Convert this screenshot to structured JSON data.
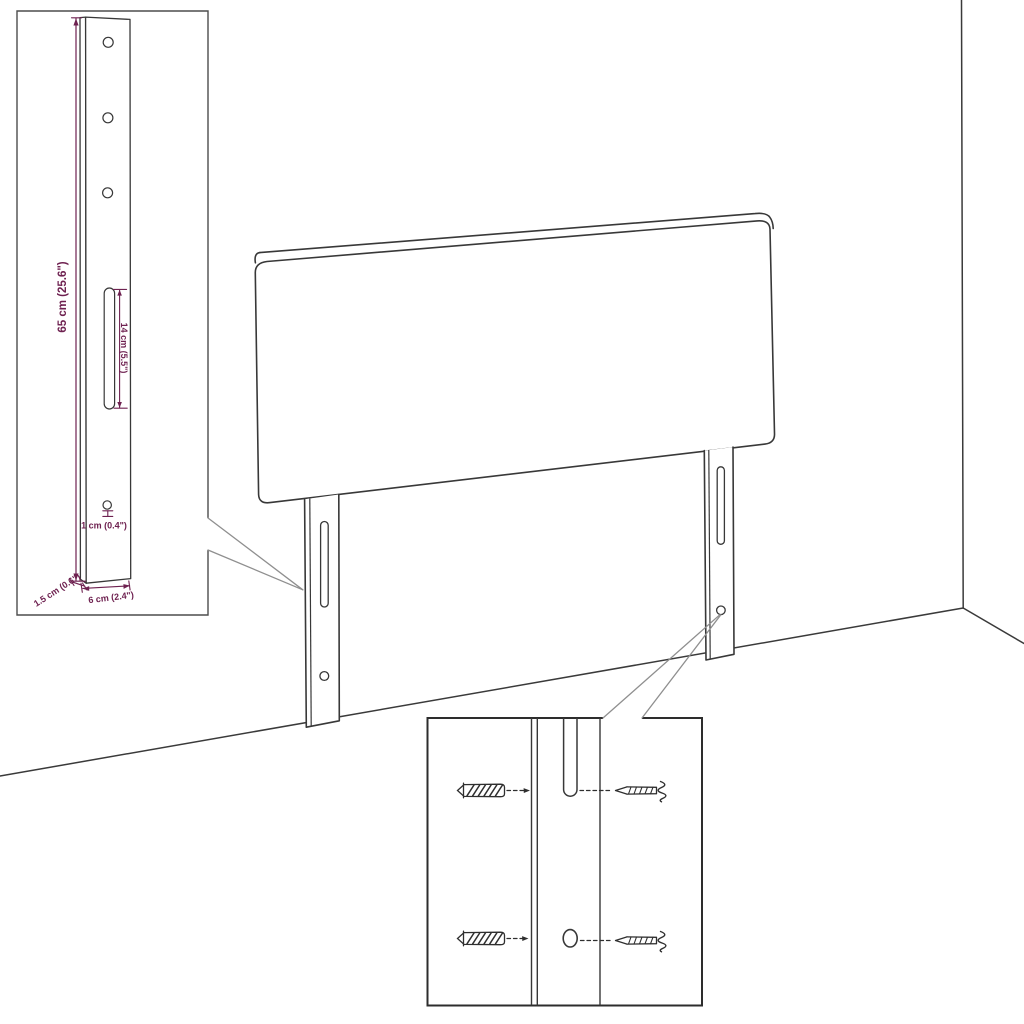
{
  "canvas": {
    "background": "#ffffff"
  },
  "colors": {
    "line": "#383838",
    "dimension": "#6e2150",
    "callout": "#8f8f8f"
  },
  "inset": {
    "dimensions": {
      "height": "65 cm (25.6\")",
      "slot_length": "14 cm (5.5\")",
      "hole_diameter": "1 cm (0.4\")",
      "edge_thickness": "1.5 cm (0.6\")",
      "leg_width": "6 cm (2.4\")"
    }
  }
}
